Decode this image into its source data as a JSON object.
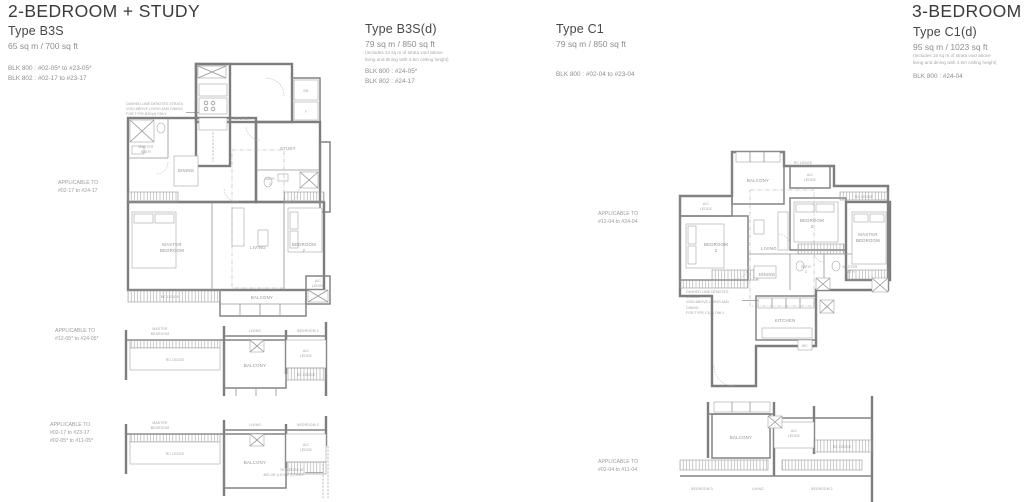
{
  "sections": {
    "left_title": "2-BEDROOM + STUDY",
    "right_title": "3-BEDROOM"
  },
  "types": {
    "b3s": {
      "name": "Type B3S",
      "area": "65 sq m / 700 sq ft",
      "blk": [
        "BLK 800 : #02-05* to #23-05*",
        "BLK 802 : #02-17 to #23-17"
      ]
    },
    "b3sd": {
      "name": "Type B3S(d)",
      "area": "79 sq m / 850 sq ft",
      "note": [
        "(Includes 14 sq m of strata void above",
        "living and dining with 4.5m ceiling height)"
      ],
      "blk": [
        "BLK 800 : #24-05*",
        "BLK 802 : #24-17"
      ]
    },
    "c1": {
      "name": "Type C1",
      "area": "79 sq m / 850 sq ft",
      "blk": [
        "BLK 800 : #02-04 to #23-04"
      ]
    },
    "c1d": {
      "name": "Type C1(d)",
      "area": "95 sq m / 1023 sq ft",
      "note": [
        "(Includes 16 sq m of strata void above",
        "living and dining with 4.5m ceiling height)"
      ],
      "blk": [
        "BLK 800 : #24-04"
      ]
    }
  },
  "applicable": {
    "b3s_main": [
      "APPLICABLE TO",
      "#02-17 to #24-17"
    ],
    "b3s_mid": [
      "APPLICABLE TO",
      "#12-05* to #24-05*"
    ],
    "b3s_low": [
      "APPLICABLE TO",
      "#02-17 to #23-17",
      "#02-05* to #11-05*"
    ],
    "c1_main": [
      "APPLICABLE TO",
      "#12-04 to #24-04"
    ],
    "c1_low": [
      "APPLICABLE TO",
      "#02-04 to #11-04"
    ]
  },
  "rooms": {
    "master1": "MASTER",
    "master2": "BEDROOM",
    "bed2a": "BEDROOM",
    "bed2b": "2",
    "bed2s": "BEDROOM 2",
    "bed3s": "BEDROOM 3",
    "living": "LIVING",
    "dining": "DINING",
    "kitchen": "KITCHEN",
    "balcony": "BALCONY",
    "study": "STUDY",
    "bath2a": "BATH",
    "bath2b": "2",
    "mbatha": "MASTER",
    "mbathb": "BATH",
    "aca": "A/C",
    "acb": "LEDGE",
    "rc": "RC LEDGE",
    "wc": "WC",
    "db": "DB",
    "f": "F"
  },
  "annotations": {
    "void_b3s": [
      "DASHED LINE DENOTES STRATA",
      "VOID ABOVE LIVING AND DINING",
      "FOR TYPE B3S(d) ONLY"
    ],
    "void_c1": [
      "DASHED LINE DENOTES STRATA",
      "VOID ABOVE LIVING AND DINING",
      "FOR TYPE C1(d) ONLY"
    ],
    "rc_note": [
      "RC LEDGE AT",
      "#02-05* (LEVEL 2) ONLY"
    ]
  },
  "colors": {
    "wall": "#7d7d7d",
    "label": "#8f8f8f",
    "title": "#3a3a3a"
  }
}
